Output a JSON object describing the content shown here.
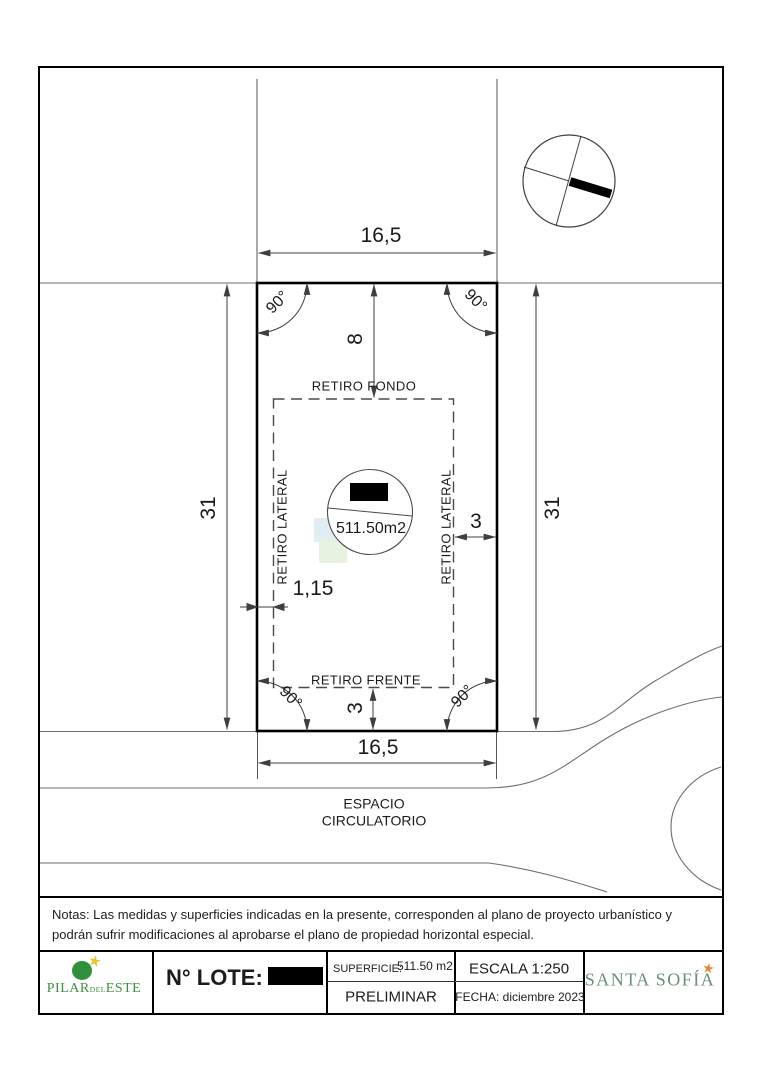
{
  "colors": {
    "line": "#3f3f3f",
    "street": "#6e6e6e",
    "lot_outline": "#000000",
    "pilar_green": "#2f8f3a",
    "pilar_text_green": "#3f8f3f",
    "sofia_green": "#688f77",
    "star_gold": "#e6c531",
    "star_orange": "#e8873c",
    "watermark_blue": "#dbeaf3",
    "watermark_green": "#e4f0dc"
  },
  "plan": {
    "dim_width_top": "16,5",
    "dim_width_bottom": "16,5",
    "dim_depth_left": "31",
    "dim_depth_right": "31",
    "dim_retiro_fondo": "8",
    "dim_retiro_frente": "3",
    "dim_retiro_lateral_right": "3",
    "dim_retiro_lateral_left": "1,15",
    "angle": "90°",
    "label_retiro_fondo": "RETIRO FONDO",
    "label_retiro_frente": "RETIRO FRENTE",
    "label_retiro_lateral": "RETIRO LATERAL",
    "area_label": "511.50m2",
    "espacio_line1": "ESPACIO",
    "espacio_line2": "CIRCULATORIO"
  },
  "notes": {
    "text": "Notas: Las medidas y superficies indicadas en la presente, corresponden al plano de proyecto urbanístico y podrán sufrir modificaciones al aprobarse el plano de propiedad horizontal especial."
  },
  "footer": {
    "pilar": {
      "word1": "PILAR",
      "word2": "DEL",
      "word3": "ESTE",
      "star": "★"
    },
    "lote_label": "N° LOTE:",
    "superficie_label": "SUPERFICIE:",
    "superficie_value": "511.50 m2",
    "preliminar": "PRELIMINAR",
    "escala": "ESCALA 1:250",
    "fecha": "FECHA: diciembre 2023",
    "santa_sofia": "SANTA SOFÍA",
    "sofia_star": "★"
  }
}
